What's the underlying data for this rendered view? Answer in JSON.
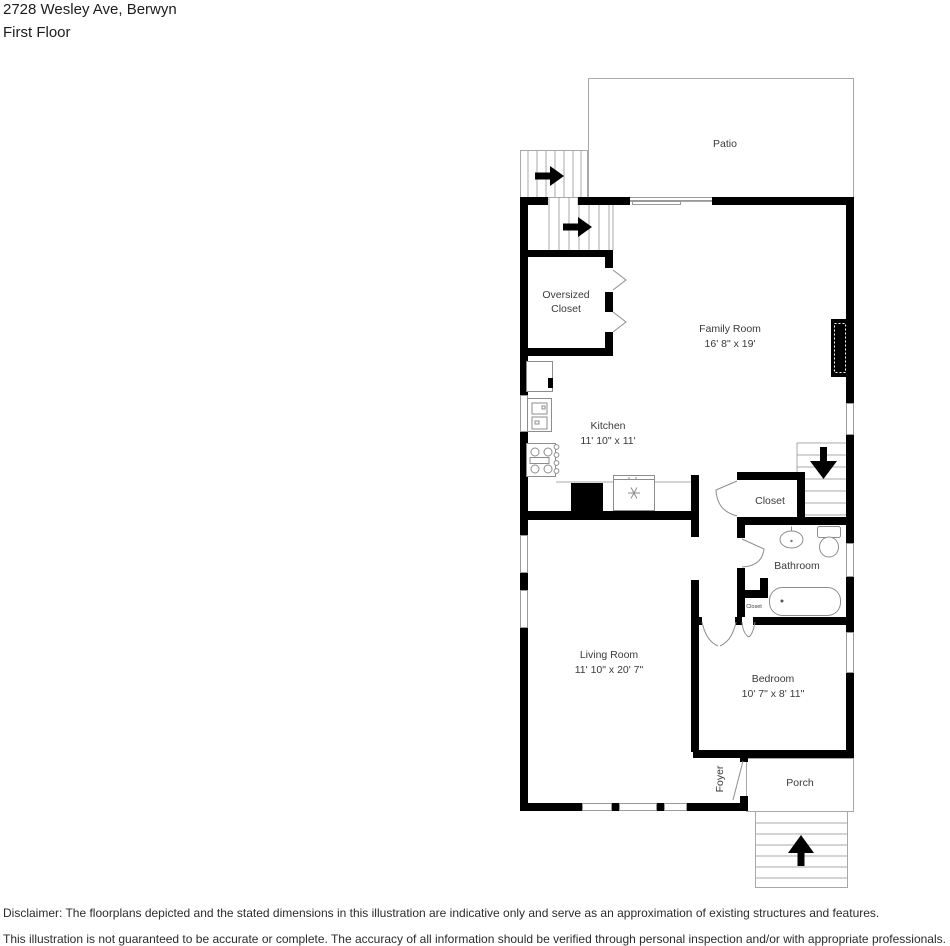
{
  "header": {
    "address": "2728 Wesley Ave, Berwyn",
    "floor": "First Floor"
  },
  "rooms": {
    "patio": {
      "label": "Patio"
    },
    "oversized_closet": {
      "label_line1": "Oversized",
      "label_line2": "Closet"
    },
    "family_room": {
      "label": "Family Room",
      "dims": "16' 8\" x 19'"
    },
    "kitchen": {
      "label": "Kitchen",
      "dims": "11' 10\" x 11'"
    },
    "closet": {
      "label": "Closet"
    },
    "bathroom": {
      "label": "Bathroom"
    },
    "small_closet": {
      "label": "Closet"
    },
    "living_room": {
      "label": "Living Room",
      "dims": "11' 10\" x 20' 7\""
    },
    "bedroom": {
      "label": "Bedroom",
      "dims": "10' 7\" x 8' 11\""
    },
    "foyer": {
      "label": "Foyer"
    },
    "porch": {
      "label": "Porch"
    }
  },
  "footer": {
    "disclaimer_line1": "Disclaimer: The floorplans depicted and the stated dimensions in this illustration are indicative only and serve as an approximation of existing structures and features.",
    "disclaimer_line2": "This illustration is not guaranteed to be accurate or complete. The accuracy of all information should be verified through personal inspection and/or with appropriate professionals."
  },
  "colors": {
    "wall": "#000000",
    "thin_line": "#9a9a9a",
    "label_text": "#3a3a3a"
  }
}
